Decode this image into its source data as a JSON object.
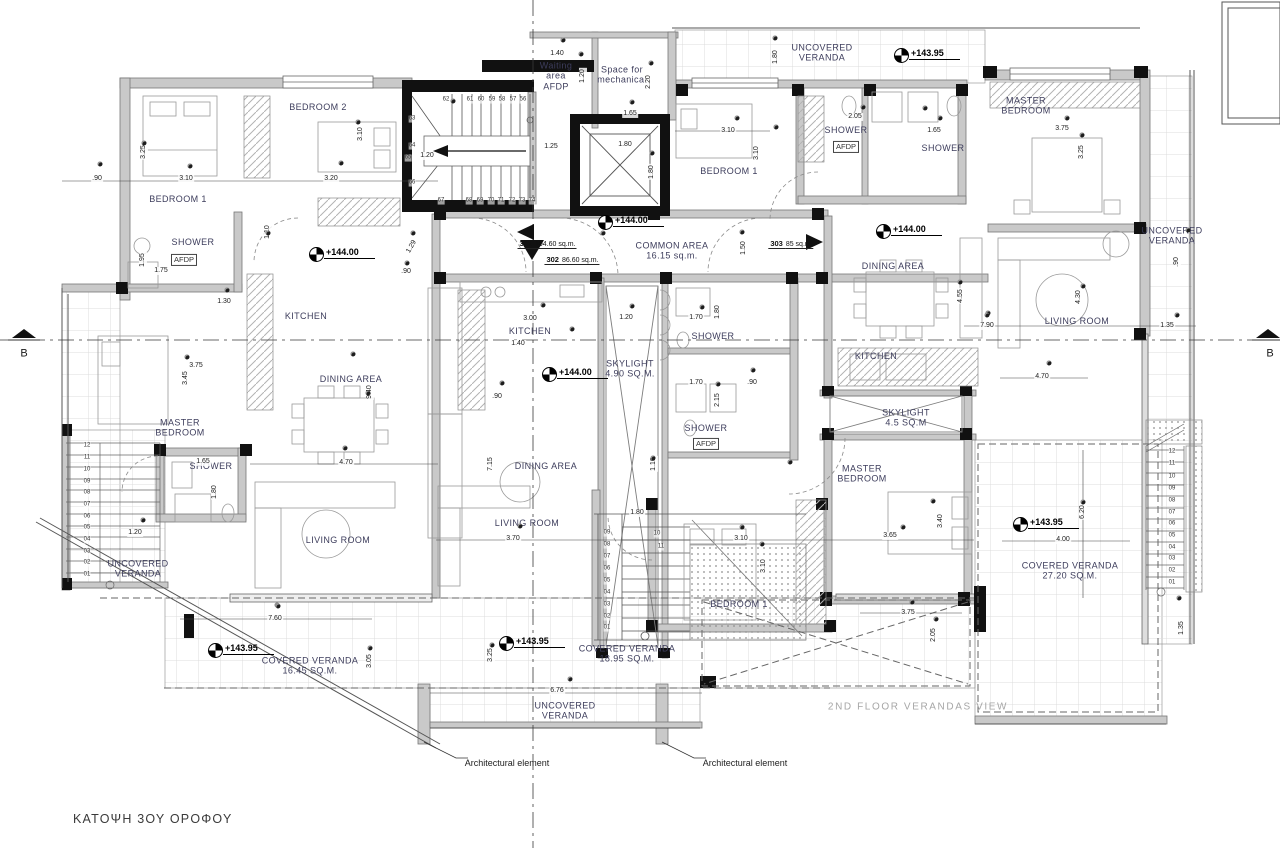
{
  "title": "ΚΑΤΟΨΗ 3ΟΥ ΟΡΟΦΟΥ",
  "watermark": "2ND FLOOR VERANDAS VIEW",
  "section_label": "B",
  "annotations": {
    "architectural_element": "Architectural element"
  },
  "colors": {
    "room_label": "#3d3d5c",
    "wall_gray": "#c9c9c9",
    "wall_black": "#111111",
    "grid": "#dcdcdc",
    "watermark": "#a6a6a6"
  },
  "units": [
    {
      "number": "301",
      "area": "104.60 sq.m.",
      "x": 547,
      "y": 242
    },
    {
      "number": "302",
      "area": "86.60 sq.m.",
      "x": 572,
      "y": 258
    },
    {
      "number": "303",
      "area": "85 sq.m.",
      "x": 791,
      "y": 242
    }
  ],
  "levels": [
    {
      "t": "+143.95",
      "x": 901,
      "y": 57
    },
    {
      "t": "+144.00",
      "x": 605,
      "y": 224
    },
    {
      "t": "+144.00",
      "x": 883,
      "y": 233
    },
    {
      "t": "+144.00",
      "x": 316,
      "y": 256
    },
    {
      "t": "+144.00",
      "x": 549,
      "y": 376
    },
    {
      "t": "+143.95",
      "x": 215,
      "y": 652
    },
    {
      "t": "+143.95",
      "x": 506,
      "y": 645
    },
    {
      "t": "+143.95",
      "x": 1020,
      "y": 526
    }
  ],
  "rooms": [
    {
      "t": "BEDROOM 2",
      "x": 318,
      "y": 107
    },
    {
      "t": "BEDROOM 1",
      "x": 178,
      "y": 199
    },
    {
      "t": "SHOWER",
      "x": 193,
      "y": 242
    },
    {
      "t": "KITCHEN",
      "x": 306,
      "y": 316
    },
    {
      "t": "DINING AREA",
      "x": 351,
      "y": 379
    },
    {
      "t": "MASTER\nBEDROOM",
      "x": 180,
      "y": 428
    },
    {
      "t": "SHOWER",
      "x": 211,
      "y": 466
    },
    {
      "t": "LIVING ROOM",
      "x": 338,
      "y": 540
    },
    {
      "t": "UNCOVERED\nVERANDA",
      "x": 138,
      "y": 569
    },
    {
      "t": "Waiting\narea\nAFDP",
      "x": 556,
      "y": 76
    },
    {
      "t": "Space for\nmechanical",
      "x": 622,
      "y": 75
    },
    {
      "t": "COMMON AREA\n16.15 sq.m.",
      "x": 672,
      "y": 251
    },
    {
      "t": "KITCHEN",
      "x": 530,
      "y": 331
    },
    {
      "t": "SKYLIGHT\n4.90 SQ.M.",
      "x": 630,
      "y": 369
    },
    {
      "t": "SHOWER",
      "x": 713,
      "y": 336
    },
    {
      "t": "SHOWER",
      "x": 706,
      "y": 428
    },
    {
      "t": "DINING AREA",
      "x": 546,
      "y": 466
    },
    {
      "t": "LIVING ROOM",
      "x": 527,
      "y": 523
    },
    {
      "t": "BEDROOM 1",
      "x": 739,
      "y": 604
    },
    {
      "t": "BEDROOM 1",
      "x": 729,
      "y": 171
    },
    {
      "t": "SHOWER",
      "x": 846,
      "y": 130
    },
    {
      "t": "SHOWER",
      "x": 943,
      "y": 148
    },
    {
      "t": "UNCOVERED\nVERANDA",
      "x": 822,
      "y": 53
    },
    {
      "t": "MASTER\nBEDROOM",
      "x": 1026,
      "y": 106
    },
    {
      "t": "DINING AREA",
      "x": 893,
      "y": 266
    },
    {
      "t": "KITCHEN",
      "x": 876,
      "y": 356
    },
    {
      "t": "SKYLIGHT\n4.5 SQ.M",
      "x": 906,
      "y": 418
    },
    {
      "t": "LIVING ROOM",
      "x": 1077,
      "y": 321
    },
    {
      "t": "UNCOVERED\nVERANDA",
      "x": 1172,
      "y": 236
    },
    {
      "t": "MASTER\nBEDROOM",
      "x": 862,
      "y": 474
    },
    {
      "t": "COVERED VERANDA\n16.45 SQ.M.",
      "x": 310,
      "y": 666
    },
    {
      "t": "COVERED VERANDA\n18.95 SQ.M.",
      "x": 627,
      "y": 654
    },
    {
      "t": "COVERED VERANDA\n27.20 SQ.M.",
      "x": 1070,
      "y": 571
    },
    {
      "t": "UNCOVERED\nVERANDA",
      "x": 565,
      "y": 711
    }
  ],
  "afdp_tags": [
    {
      "t": "AFDP",
      "x": 184,
      "y": 260
    },
    {
      "t": "AFDP",
      "x": 846,
      "y": 147
    },
    {
      "t": "AFDP",
      "x": 706,
      "y": 444
    }
  ],
  "dims": [
    {
      "t": ".90",
      "x": 97,
      "y": 179
    },
    {
      "t": "3.10",
      "x": 186,
      "y": 179
    },
    {
      "t": "3.25",
      "x": 144,
      "y": 152,
      "r": -90
    },
    {
      "t": "3.20",
      "x": 331,
      "y": 179
    },
    {
      "t": "3.10",
      "x": 361,
      "y": 134,
      "r": -90
    },
    {
      "t": "1.20",
      "x": 427,
      "y": 156
    },
    {
      "t": "1.25",
      "x": 551,
      "y": 147
    },
    {
      "t": "1.40",
      "x": 557,
      "y": 54
    },
    {
      "t": "1.20",
      "x": 583,
      "y": 76,
      "r": -90
    },
    {
      "t": "1.65",
      "x": 630,
      "y": 114
    },
    {
      "t": "2.20",
      "x": 649,
      "y": 82,
      "r": -90
    },
    {
      "t": "1.80",
      "x": 625,
      "y": 145
    },
    {
      "t": "1.80",
      "x": 652,
      "y": 172,
      "r": -90
    },
    {
      "t": "2.05",
      "x": 855,
      "y": 117
    },
    {
      "t": "1.65",
      "x": 934,
      "y": 131
    },
    {
      "t": "1.80",
      "x": 776,
      "y": 57,
      "r": -90
    },
    {
      "t": "3.10",
      "x": 728,
      "y": 131
    },
    {
      "t": "3.10",
      "x": 757,
      "y": 153,
      "r": -90
    },
    {
      "t": "1.50",
      "x": 744,
      "y": 248,
      "r": -90
    },
    {
      "t": "3.75",
      "x": 1062,
      "y": 129
    },
    {
      "t": "3.25",
      "x": 1082,
      "y": 152,
      "r": -90
    },
    {
      "t": ".90",
      "x": 1177,
      "y": 262,
      "r": -90
    },
    {
      "t": "1.10",
      "x": 268,
      "y": 232,
      "r": -90
    },
    {
      "t": "1.29",
      "x": 412,
      "y": 247,
      "r": -60
    },
    {
      "t": ".90",
      "x": 406,
      "y": 272
    },
    {
      "t": "1.30",
      "x": 224,
      "y": 302
    },
    {
      "t": "1.75",
      "x": 161,
      "y": 271
    },
    {
      "t": "1.95",
      "x": 143,
      "y": 260,
      "r": -90
    },
    {
      "t": "3.75",
      "x": 196,
      "y": 366
    },
    {
      "t": "3.45",
      "x": 186,
      "y": 378,
      "r": -90
    },
    {
      "t": "3.00",
      "x": 530,
      "y": 319
    },
    {
      "t": "1.40",
      "x": 518,
      "y": 344
    },
    {
      "t": "1.20",
      "x": 626,
      "y": 318
    },
    {
      "t": "1.70",
      "x": 696,
      "y": 318
    },
    {
      "t": "1.80",
      "x": 718,
      "y": 312,
      "r": -90
    },
    {
      "t": "1.70",
      "x": 696,
      "y": 383
    },
    {
      "t": ".90",
      "x": 752,
      "y": 383
    },
    {
      "t": "2.15",
      "x": 718,
      "y": 400,
      "r": -90
    },
    {
      "t": ".90",
      "x": 497,
      "y": 397
    },
    {
      "t": "7.15",
      "x": 491,
      "y": 464,
      "r": -90
    },
    {
      "t": "9.40",
      "x": 370,
      "y": 392,
      "r": -90
    },
    {
      "t": "4.70",
      "x": 346,
      "y": 463
    },
    {
      "t": "4.55",
      "x": 961,
      "y": 296,
      "r": -90
    },
    {
      "t": "7.90",
      "x": 987,
      "y": 326
    },
    {
      "t": "4.30",
      "x": 1079,
      "y": 297,
      "r": -90
    },
    {
      "t": "1.35",
      "x": 1167,
      "y": 326
    },
    {
      "t": "4.70",
      "x": 1042,
      "y": 377
    },
    {
      "t": "1.20",
      "x": 135,
      "y": 533
    },
    {
      "t": "1.65",
      "x": 203,
      "y": 462
    },
    {
      "t": "1.80",
      "x": 215,
      "y": 492,
      "r": -90
    },
    {
      "t": "7.60",
      "x": 275,
      "y": 619
    },
    {
      "t": "3.05",
      "x": 370,
      "y": 661,
      "r": -90
    },
    {
      "t": "3.25",
      "x": 491,
      "y": 655,
      "r": -90
    },
    {
      "t": "6.76",
      "x": 557,
      "y": 691
    },
    {
      "t": "1.80",
      "x": 637,
      "y": 513
    },
    {
      "t": "3.70",
      "x": 513,
      "y": 539
    },
    {
      "t": "1.10",
      "x": 654,
      "y": 464,
      "r": -90
    },
    {
      "t": "3.10",
      "x": 741,
      "y": 539
    },
    {
      "t": "3.10",
      "x": 764,
      "y": 566,
      "r": -90
    },
    {
      "t": "3.65",
      "x": 890,
      "y": 536
    },
    {
      "t": "3.40",
      "x": 941,
      "y": 521,
      "r": -90
    },
    {
      "t": "3.75",
      "x": 908,
      "y": 613
    },
    {
      "t": "2.05",
      "x": 934,
      "y": 635,
      "r": -90
    },
    {
      "t": "4.00",
      "x": 1063,
      "y": 540
    },
    {
      "t": "6.20",
      "x": 1083,
      "y": 512,
      "r": -90
    },
    {
      "t": "1.35",
      "x": 1182,
      "y": 628,
      "r": -90
    }
  ],
  "stair_numbers": [
    {
      "t": "62",
      "x": 446,
      "y": 100
    },
    {
      "t": "61",
      "x": 470,
      "y": 100
    },
    {
      "t": "60",
      "x": 481,
      "y": 100
    },
    {
      "t": "59",
      "x": 492,
      "y": 100
    },
    {
      "t": "58",
      "x": 502,
      "y": 100
    },
    {
      "t": "57",
      "x": 513,
      "y": 100
    },
    {
      "t": "56",
      "x": 523,
      "y": 100
    },
    {
      "t": "63",
      "x": 412,
      "y": 119
    },
    {
      "t": "64",
      "x": 412,
      "y": 146
    },
    {
      "t": "65",
      "x": 408,
      "y": 158
    },
    {
      "t": "66",
      "x": 412,
      "y": 183
    },
    {
      "t": "67",
      "x": 441,
      "y": 201
    },
    {
      "t": "68",
      "x": 469,
      "y": 201
    },
    {
      "t": "69",
      "x": 480,
      "y": 201
    },
    {
      "t": "70",
      "x": 491,
      "y": 201
    },
    {
      "t": "71",
      "x": 501,
      "y": 201
    },
    {
      "t": "72",
      "x": 512,
      "y": 201
    },
    {
      "t": "73",
      "x": 522,
      "y": 201
    },
    {
      "t": "74",
      "x": 532,
      "y": 201
    },
    {
      "t": "09",
      "x": 607,
      "y": 533
    },
    {
      "t": "08",
      "x": 607,
      "y": 545
    },
    {
      "t": "07",
      "x": 607,
      "y": 557
    },
    {
      "t": "06",
      "x": 607,
      "y": 569
    },
    {
      "t": "05",
      "x": 607,
      "y": 581
    },
    {
      "t": "04",
      "x": 607,
      "y": 593
    },
    {
      "t": "03",
      "x": 607,
      "y": 605
    },
    {
      "t": "02",
      "x": 607,
      "y": 617
    },
    {
      "t": "01",
      "x": 607,
      "y": 628
    },
    {
      "t": "10",
      "x": 657,
      "y": 534
    },
    {
      "t": "11",
      "x": 661,
      "y": 547
    },
    {
      "t": "12",
      "x": 87,
      "y": 446
    },
    {
      "t": "11",
      "x": 87,
      "y": 458
    },
    {
      "t": "10",
      "x": 87,
      "y": 470
    },
    {
      "t": "09",
      "x": 87,
      "y": 482
    },
    {
      "t": "08",
      "x": 87,
      "y": 493
    },
    {
      "t": "07",
      "x": 87,
      "y": 505
    },
    {
      "t": "06",
      "x": 87,
      "y": 517
    },
    {
      "t": "05",
      "x": 87,
      "y": 528
    },
    {
      "t": "04",
      "x": 87,
      "y": 540
    },
    {
      "t": "03",
      "x": 87,
      "y": 552
    },
    {
      "t": "02",
      "x": 87,
      "y": 563
    },
    {
      "t": "01",
      "x": 87,
      "y": 575
    },
    {
      "t": "12",
      "x": 1172,
      "y": 452
    },
    {
      "t": "11",
      "x": 1172,
      "y": 464
    },
    {
      "t": "10",
      "x": 1172,
      "y": 477
    },
    {
      "t": "09",
      "x": 1172,
      "y": 489
    },
    {
      "t": "08",
      "x": 1172,
      "y": 501
    },
    {
      "t": "07",
      "x": 1172,
      "y": 513
    },
    {
      "t": "06",
      "x": 1172,
      "y": 524
    },
    {
      "t": "05",
      "x": 1172,
      "y": 536
    },
    {
      "t": "04",
      "x": 1172,
      "y": 548
    },
    {
      "t": "03",
      "x": 1172,
      "y": 559
    },
    {
      "t": "02",
      "x": 1172,
      "y": 571
    },
    {
      "t": "01",
      "x": 1172,
      "y": 583
    }
  ],
  "dots": [
    [
      100,
      164
    ],
    [
      144,
      143
    ],
    [
      190,
      166
    ],
    [
      341,
      163
    ],
    [
      358,
      122
    ],
    [
      581,
      54
    ],
    [
      563,
      40
    ],
    [
      651,
      63
    ],
    [
      632,
      102
    ],
    [
      652,
      153
    ],
    [
      453,
      101
    ],
    [
      775,
      38
    ],
    [
      737,
      118
    ],
    [
      776,
      127
    ],
    [
      863,
      107
    ],
    [
      925,
      108
    ],
    [
      940,
      118
    ],
    [
      742,
      232
    ],
    [
      1067,
      118
    ],
    [
      1082,
      135
    ],
    [
      1188,
      230
    ],
    [
      1177,
      315
    ],
    [
      988,
      313
    ],
    [
      1083,
      286
    ],
    [
      268,
      233
    ],
    [
      413,
      233
    ],
    [
      407,
      263
    ],
    [
      227,
      290
    ],
    [
      353,
      354
    ],
    [
      187,
      357
    ],
    [
      368,
      393
    ],
    [
      345,
      448
    ],
    [
      603,
      233
    ],
    [
      543,
      305
    ],
    [
      632,
      306
    ],
    [
      702,
      307
    ],
    [
      572,
      329
    ],
    [
      502,
      383
    ],
    [
      653,
      458
    ],
    [
      718,
      384
    ],
    [
      753,
      370
    ],
    [
      960,
      282
    ],
    [
      987,
      315
    ],
    [
      1049,
      363
    ],
    [
      143,
      520
    ],
    [
      277,
      605
    ],
    [
      370,
      648
    ],
    [
      520,
      526
    ],
    [
      492,
      645
    ],
    [
      570,
      679
    ],
    [
      790,
      462
    ],
    [
      742,
      527
    ],
    [
      762,
      544
    ],
    [
      903,
      527
    ],
    [
      933,
      501
    ],
    [
      912,
      602
    ],
    [
      936,
      619
    ],
    [
      1083,
      502
    ],
    [
      1179,
      598
    ],
    [
      278,
      606
    ]
  ]
}
